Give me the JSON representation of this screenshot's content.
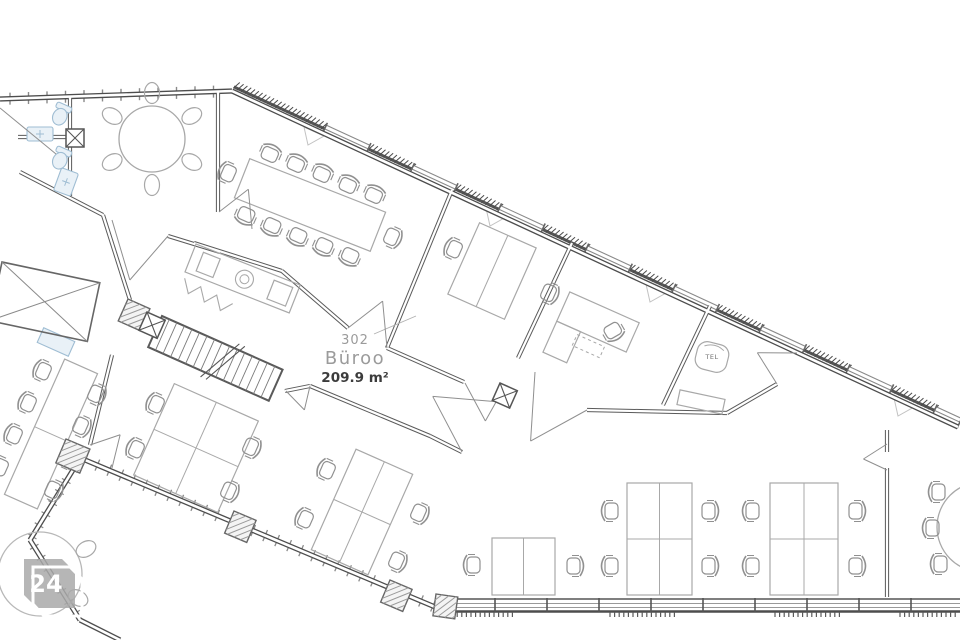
{
  "room": {
    "number": "302",
    "name": "Büroo",
    "area": "209.9 m²"
  },
  "labels": {
    "tel": "TEL"
  },
  "watermark": {
    "number": "24"
  },
  "colors": {
    "background": "#ffffff",
    "wall": "#4d4d4d",
    "interior_wall": "#5a5a5a",
    "window_line": "#8a8a8a",
    "furniture": "#a8a8a8",
    "chair": "#909090",
    "fixture_stroke": "#9fbdd3",
    "fixture_fill": "#e9f1f7",
    "door_line": "#8f8f8f",
    "label_gray": "#9b9b9b",
    "label_dark": "#3c3c3c",
    "watermark_gray": "#a9a9a9",
    "triangle_mark": "#c2c2c2"
  }
}
